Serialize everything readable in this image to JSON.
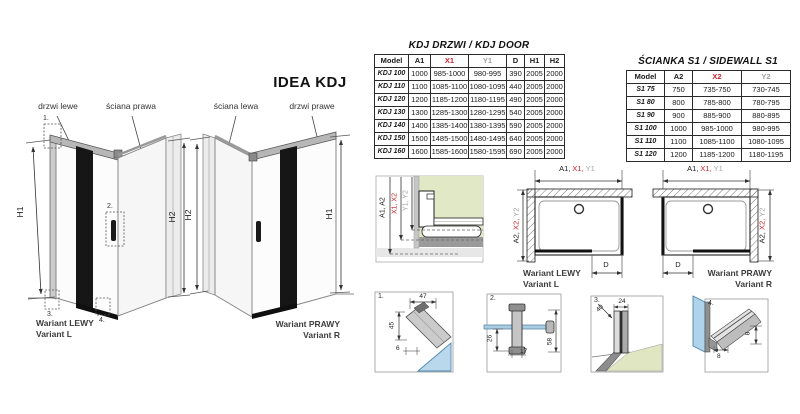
{
  "page": {
    "title": "IDEA KDJ"
  },
  "colors": {
    "accent_red": "#c9242b",
    "dim_gray": "#a2a2a2",
    "highlight_green": "#e1e8c6",
    "glass_blue": "#aed3ea"
  },
  "left_drawing": {
    "door_label": "drzwi lewe",
    "wall_label": "ściana prawa",
    "h1": "H1",
    "h2": "H2",
    "variant_line1": "Wariant LEWY",
    "variant_line2": "Variant L",
    "callout1": "1.",
    "callout2": "2.",
    "callout3": "3.",
    "callout4": "4."
  },
  "right_drawing": {
    "wall_label": "ściana lewa",
    "door_label": "drzwi prawe",
    "h1": "H1",
    "h2": "H2",
    "variant_line1": "Wariant PRAWY",
    "variant_line2": "Variant R"
  },
  "door_table": {
    "title": "KDJ DRZWI / KDJ DOOR",
    "headers": [
      "Model",
      "A1",
      "X1",
      "Y1",
      "D",
      "H1",
      "H2"
    ],
    "header_colors": [
      "black",
      "black",
      "red",
      "gray",
      "black",
      "black",
      "black"
    ],
    "rows": [
      [
        "KDJ 100",
        "1000",
        "985-1000",
        "980-995",
        "390",
        "2005",
        "2000"
      ],
      [
        "KDJ 110",
        "1100",
        "1085-1100",
        "1080-1095",
        "440",
        "2005",
        "2000"
      ],
      [
        "KDJ 120",
        "1200",
        "1185-1200",
        "1180-1195",
        "490",
        "2005",
        "2000"
      ],
      [
        "KDJ 130",
        "1300",
        "1285-1300",
        "1280-1295",
        "540",
        "2005",
        "2000"
      ],
      [
        "KDJ 140",
        "1400",
        "1385-1400",
        "1380-1395",
        "590",
        "2005",
        "2000"
      ],
      [
        "KDJ 150",
        "1500",
        "1485-1500",
        "1480-1495",
        "640",
        "2005",
        "2000"
      ],
      [
        "KDJ 160",
        "1600",
        "1585-1600",
        "1580-1595",
        "690",
        "2005",
        "2000"
      ]
    ]
  },
  "sidewall_table": {
    "title": "ŚCIANKA S1 / SIDEWALL S1",
    "headers": [
      "Model",
      "A2",
      "X2",
      "Y2"
    ],
    "header_colors": [
      "black",
      "black",
      "red",
      "gray"
    ],
    "rows": [
      [
        "S1 75",
        "750",
        "735-750",
        "730-745"
      ],
      [
        "S1 80",
        "800",
        "785-800",
        "780-795"
      ],
      [
        "S1 90",
        "900",
        "885-900",
        "880-895"
      ],
      [
        "S1 100",
        "1000",
        "985-1000",
        "980-995"
      ],
      [
        "S1 110",
        "1100",
        "1085-1100",
        "1080-1095"
      ],
      [
        "S1 120",
        "1200",
        "1185-1200",
        "1180-1195"
      ]
    ]
  },
  "section_detail": {
    "dim_a": "A1, A2",
    "dim_x": "X1, X2",
    "dim_y": "Y1, Y2"
  },
  "top_view_left": {
    "dim_a1": "A1,",
    "dim_x1": "X1,",
    "dim_y1": "Y1",
    "dim_a2": "A2,",
    "dim_x2": "X2,",
    "dim_y2": "Y2",
    "dim_d": "D",
    "variant_line1": "Wariant LEWY",
    "variant_line2": "Variant L"
  },
  "top_view_right": {
    "dim_a1": "A1,",
    "dim_x1": "X1,",
    "dim_y1": "Y1",
    "dim_a2": "A2,",
    "dim_x2": "X2,",
    "dim_y2": "Y2",
    "dim_d": "D",
    "variant_line1": "Wariant PRAWY",
    "variant_line2": "Variant R"
  },
  "details": {
    "d1": {
      "no": "1.",
      "dim_width": "47",
      "dim_height": "45",
      "dim_glass": "6"
    },
    "d2": {
      "no": "2.",
      "dim_depth": "26",
      "dim_width": "17",
      "dim_length": "58"
    },
    "d3": {
      "no": "3.",
      "dim_diag": "40",
      "dim_width": "24"
    },
    "d4": {
      "no": "4.",
      "dim_width": "8",
      "dim_height": "8"
    }
  }
}
